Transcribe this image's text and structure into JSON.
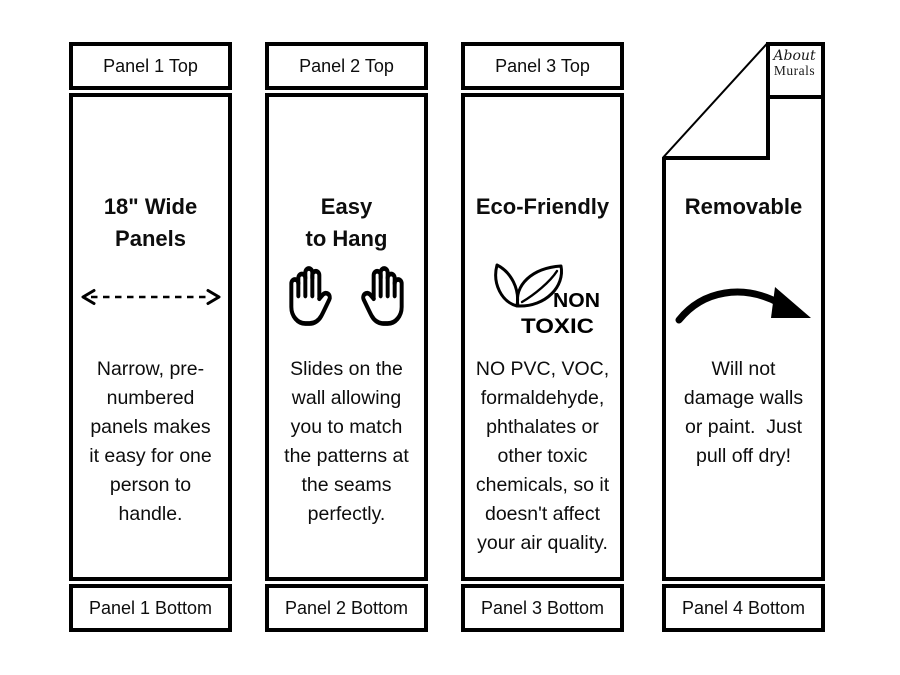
{
  "colors": {
    "background": "#ffffff",
    "ink": "#000000",
    "text": "#0d0d0d"
  },
  "logo": {
    "brand_top": "About",
    "brand_bottom": "Murals"
  },
  "panels": [
    {
      "header": "Panel 1 Top",
      "title": [
        "18\" Wide",
        "Panels"
      ],
      "icon": "dashed-width-arrow-icon",
      "body": [
        "Narrow, pre-",
        "numbered",
        "panels makes",
        "it easy for one",
        "person to",
        "handle."
      ],
      "footer": "Panel 1 Bottom"
    },
    {
      "header": "Panel 2 Top",
      "title": [
        "Easy",
        "to Hang"
      ],
      "icon": "two-hands-icon",
      "body": [
        "Slides on the",
        "wall allowing",
        "you to match",
        "the patterns at",
        "the seams",
        "perfectly."
      ],
      "footer": "Panel 2 Bottom"
    },
    {
      "header": "Panel 3 Top",
      "title": [
        "Eco-Friendly"
      ],
      "icon": "non-toxic-leaves-icon",
      "icon_text_top": "NON",
      "icon_text_bottom": "TOXIC",
      "body": [
        "NO PVC, VOC,",
        "formaldehyde,",
        "phthalates or",
        "other toxic",
        "chemicals, so it",
        "doesn't affect",
        "your air quality."
      ],
      "footer": "Panel 3 Bottom"
    },
    {
      "title": [
        "Removable"
      ],
      "icon": "curved-arrow-icon",
      "body": [
        "Will not",
        "damage walls",
        "or paint.  Just",
        "pull off dry!"
      ],
      "footer": "Panel 4 Bottom"
    }
  ]
}
